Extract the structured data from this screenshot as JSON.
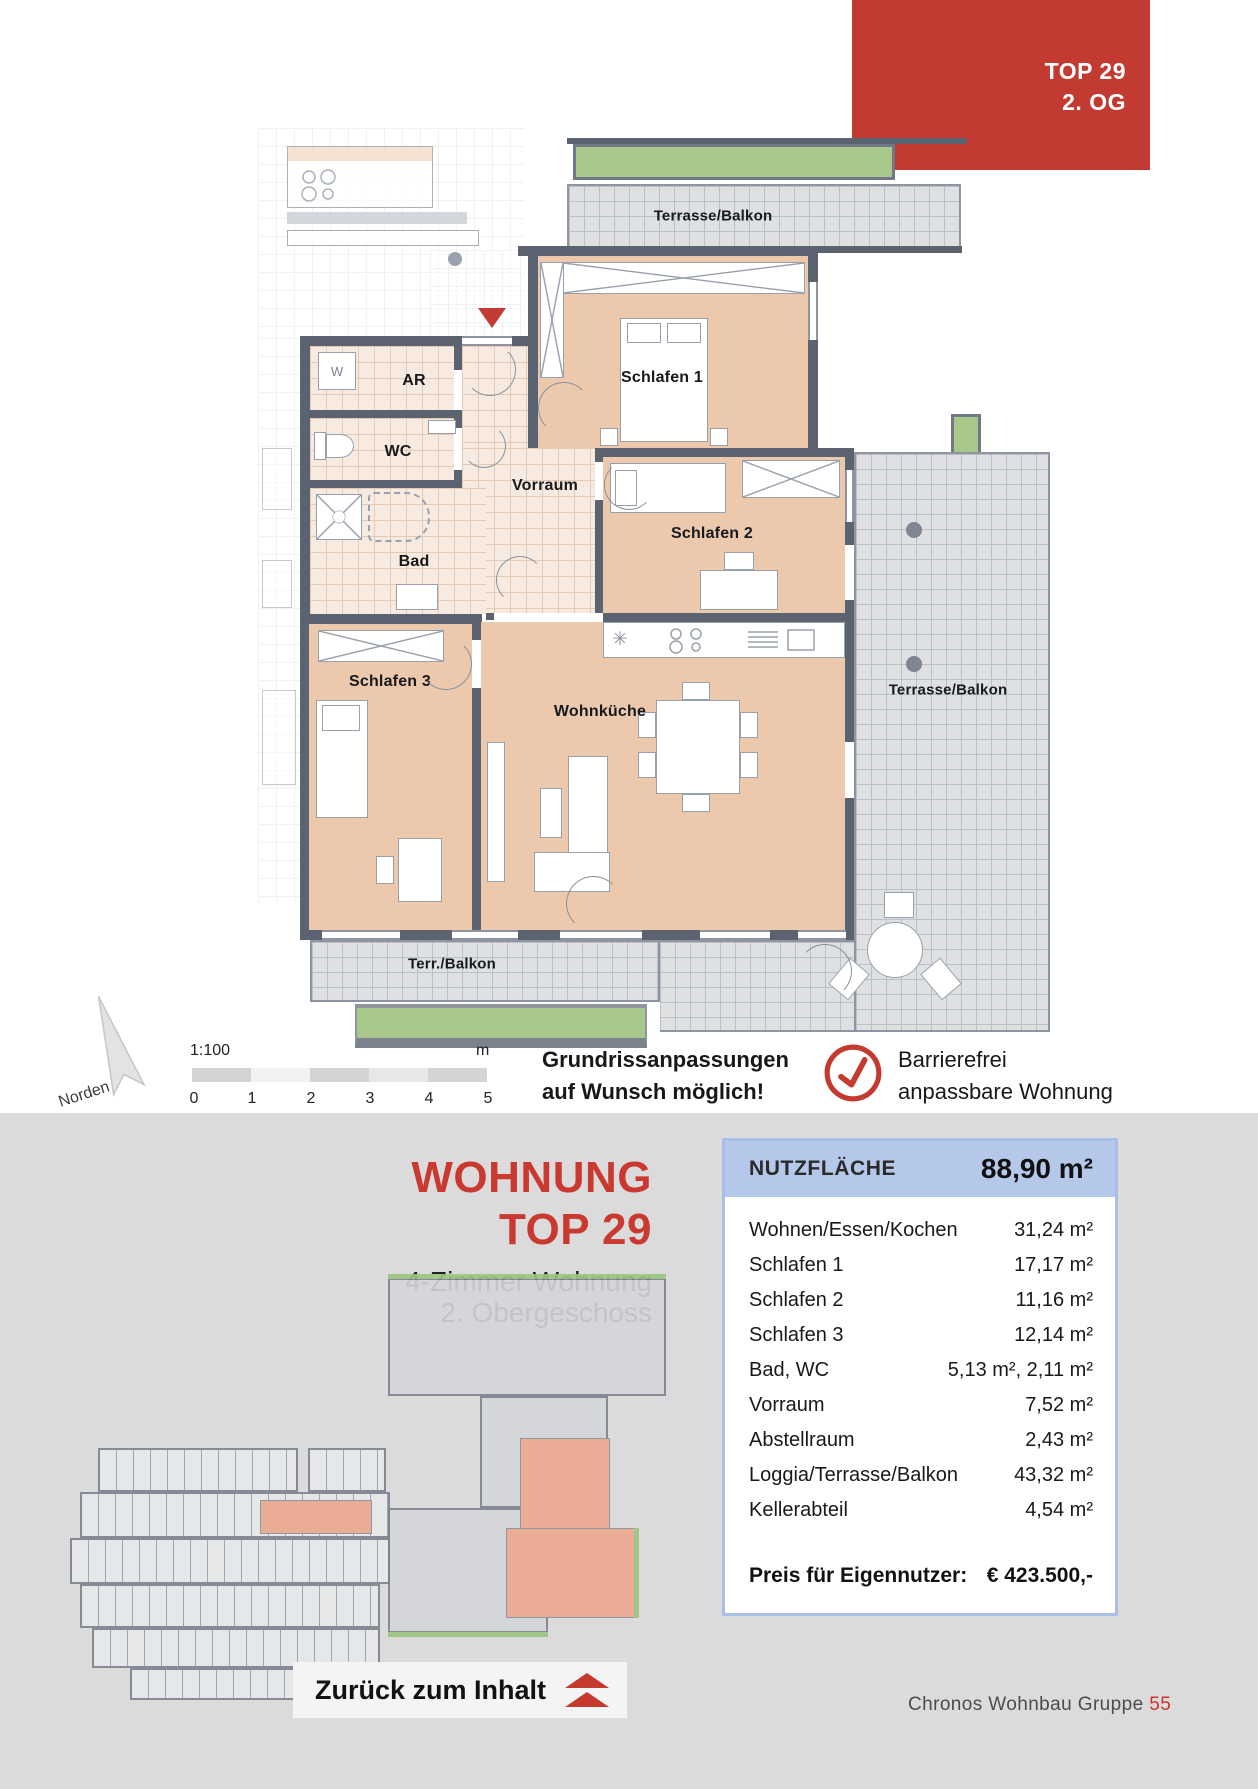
{
  "tag": {
    "line1": "TOP 29",
    "line2": "2. OG"
  },
  "plan": {
    "labels": {
      "terrasse_top": "Terrasse/Balkon",
      "terrasse_right": "Terrasse/Balkon",
      "terrasse_bottom": "Terr./Balkon",
      "schlafen1": "Schlafen 1",
      "schlafen2": "Schlafen 2",
      "schlafen3": "Schlafen 3",
      "wohnkueche": "Wohnküche",
      "vorraum": "Vorraum",
      "bad": "Bad",
      "wc": "WC",
      "ar": "AR",
      "washer": "W"
    },
    "icons": {
      "snowflake": "✳"
    }
  },
  "legend": {
    "north_label": "Norden",
    "scale_ratio": "1:100",
    "scale_unit": "m",
    "scale_ticks": [
      "0",
      "1",
      "2",
      "3",
      "4",
      "5"
    ],
    "note_line1": "Grundrissanpassungen",
    "note_line2": "auf Wunsch möglich!",
    "accessible_line1": "Barrierefrei",
    "accessible_line2": "anpassbare Wohnung"
  },
  "panel": {
    "title_line1": "WOHNUNG",
    "title_line2": "TOP 29",
    "subtitle_line1": "4-Zimmer Wohnung",
    "subtitle_line2": "2. Obergeschoss",
    "table": {
      "header_label": "NUTZFLÄCHE",
      "header_value": "88,90 m²",
      "rows": [
        {
          "label": "Wohnen/Essen/Kochen",
          "value": "31,24 m²"
        },
        {
          "label": "Schlafen 1",
          "value": "17,17 m²"
        },
        {
          "label": "Schlafen 2",
          "value": "11,16 m²"
        },
        {
          "label": "Schlafen 3",
          "value": "12,14 m²"
        },
        {
          "label": "Bad, WC",
          "value": "5,13 m², 2,11 m²"
        },
        {
          "label": "Vorraum",
          "value": "7,52 m²"
        },
        {
          "label": "Abstellraum",
          "value": "2,43 m²"
        },
        {
          "label": "Loggia/Terrasse/Balkon",
          "value": "43,32 m²"
        },
        {
          "label": "Kellerabteil",
          "value": "4,54 m²"
        }
      ],
      "price_label": "Preis für Eigennutzer:",
      "price_value": "€ 423.500,-"
    },
    "back_button": "Zurück zum Inhalt",
    "footer_text": "Chronos Wohnbau Gruppe",
    "footer_page": "55"
  }
}
